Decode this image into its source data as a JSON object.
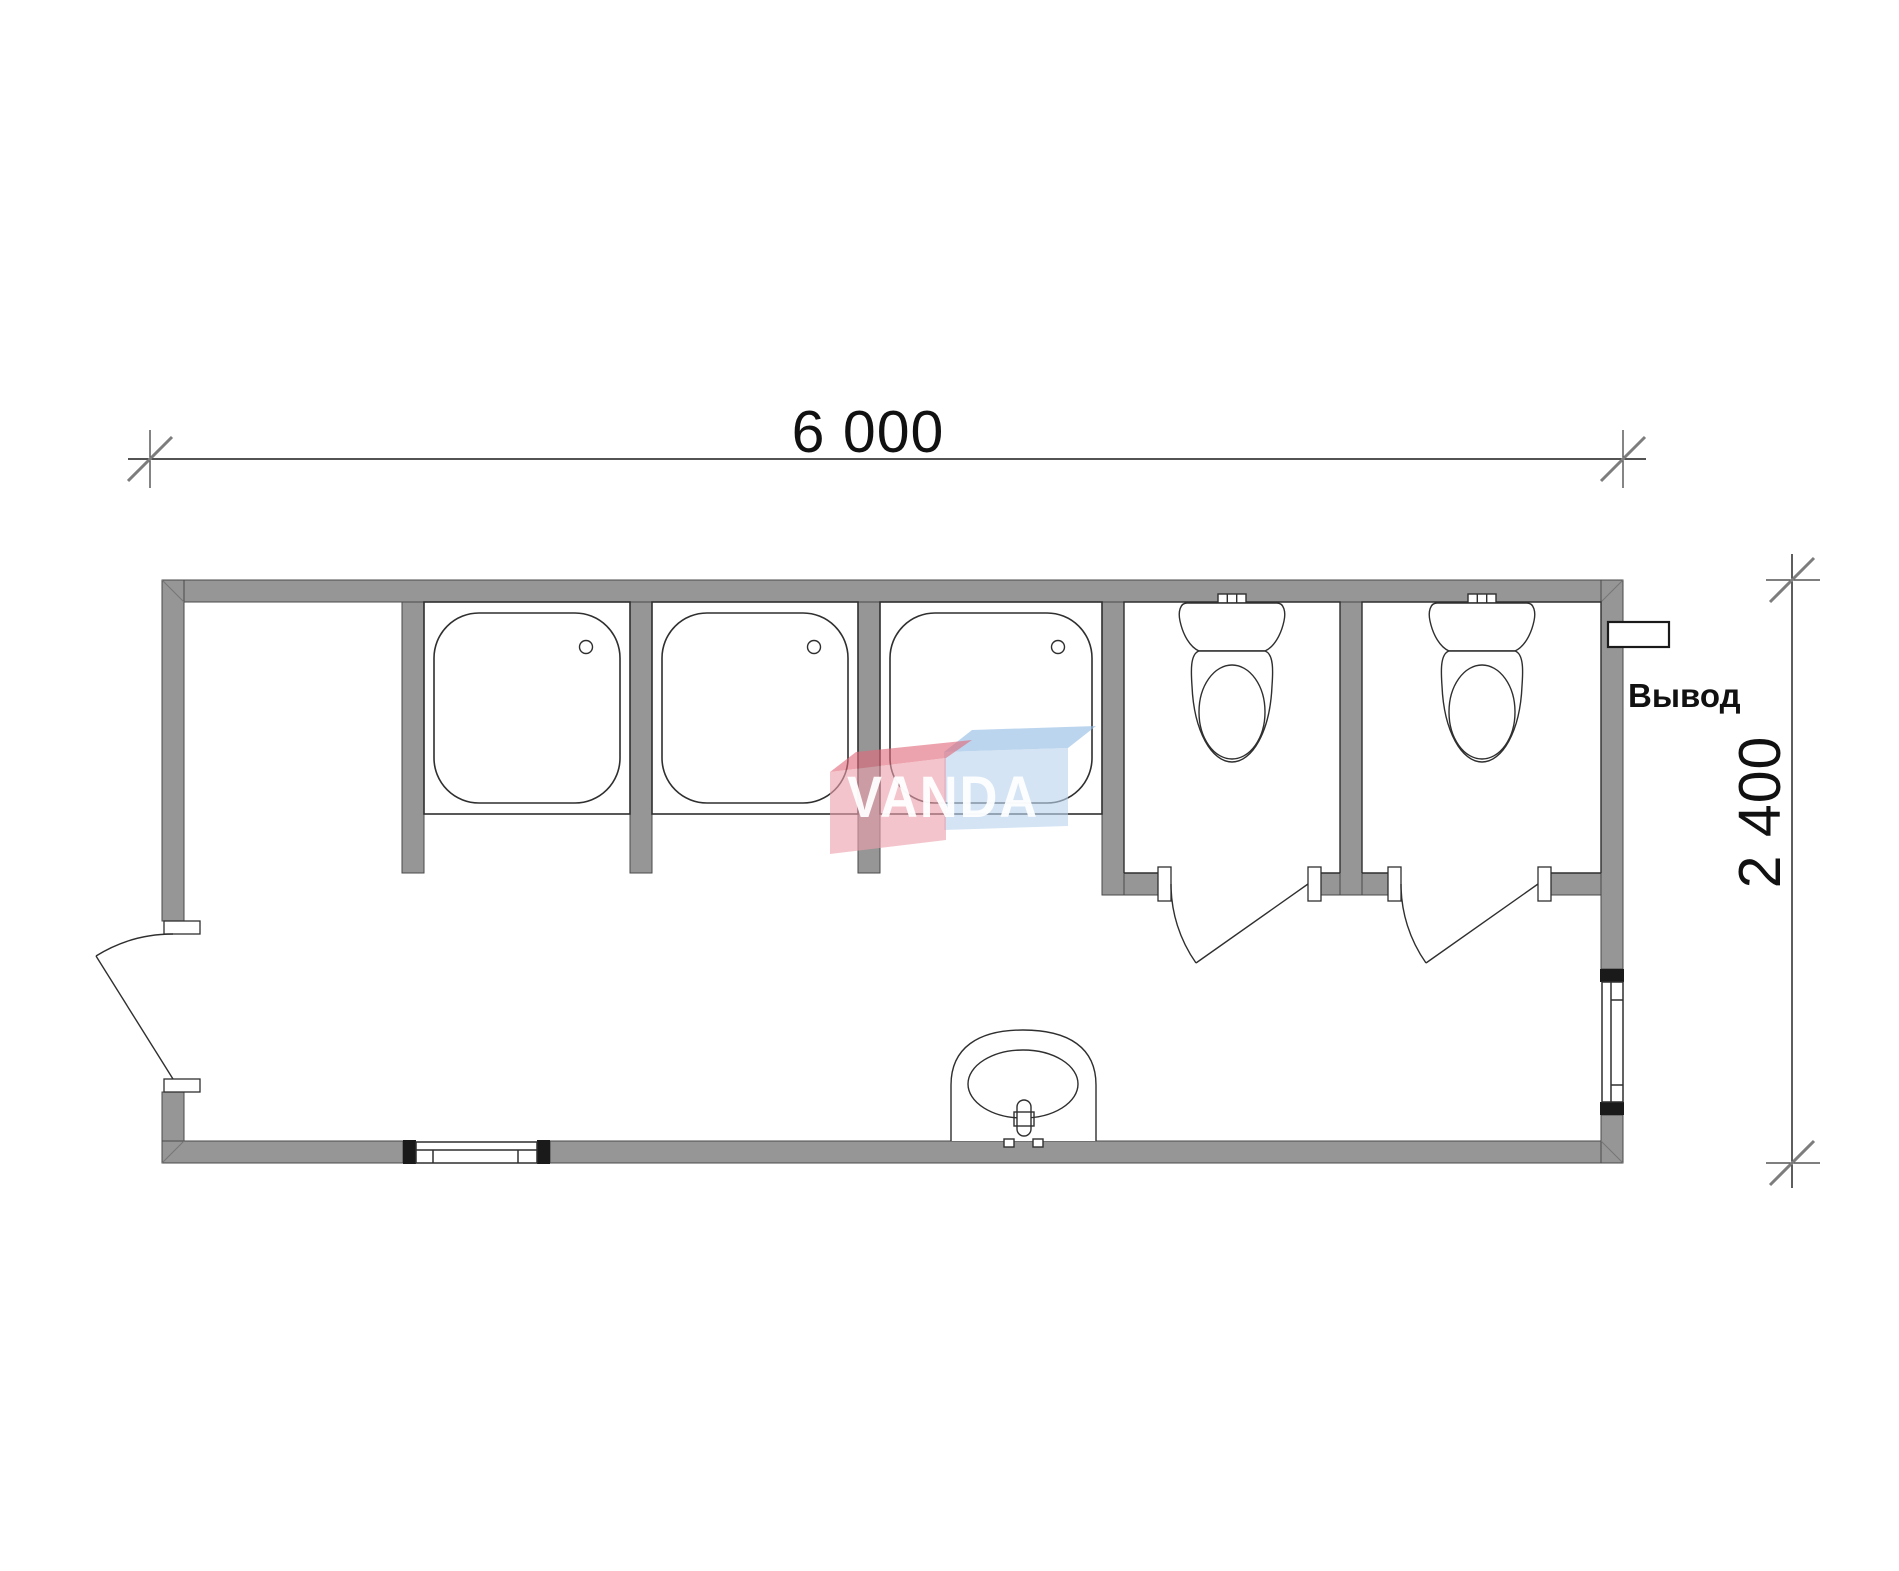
{
  "drawing": {
    "type": "floor-plan",
    "module_width_mm_label": "6 000",
    "module_depth_mm_label": "2 400",
    "outlet_label": "Вывод"
  },
  "watermark": {
    "text": "VANDA",
    "text_color": "#ffffff",
    "red_face": "#eda0ac",
    "red_top": "#e06b7a",
    "blue_face": "#b9d4ee",
    "blue_top": "#93bce4"
  },
  "colors": {
    "background": "#ffffff",
    "wall_fill": "#969696",
    "window_cap": "#1a1a1a"
  },
  "fixtures": {
    "shower_cabins": 3,
    "toilets": 2,
    "washbasins": 1,
    "entrance_doors": 1,
    "wc_doors": 2,
    "windows": 2
  }
}
